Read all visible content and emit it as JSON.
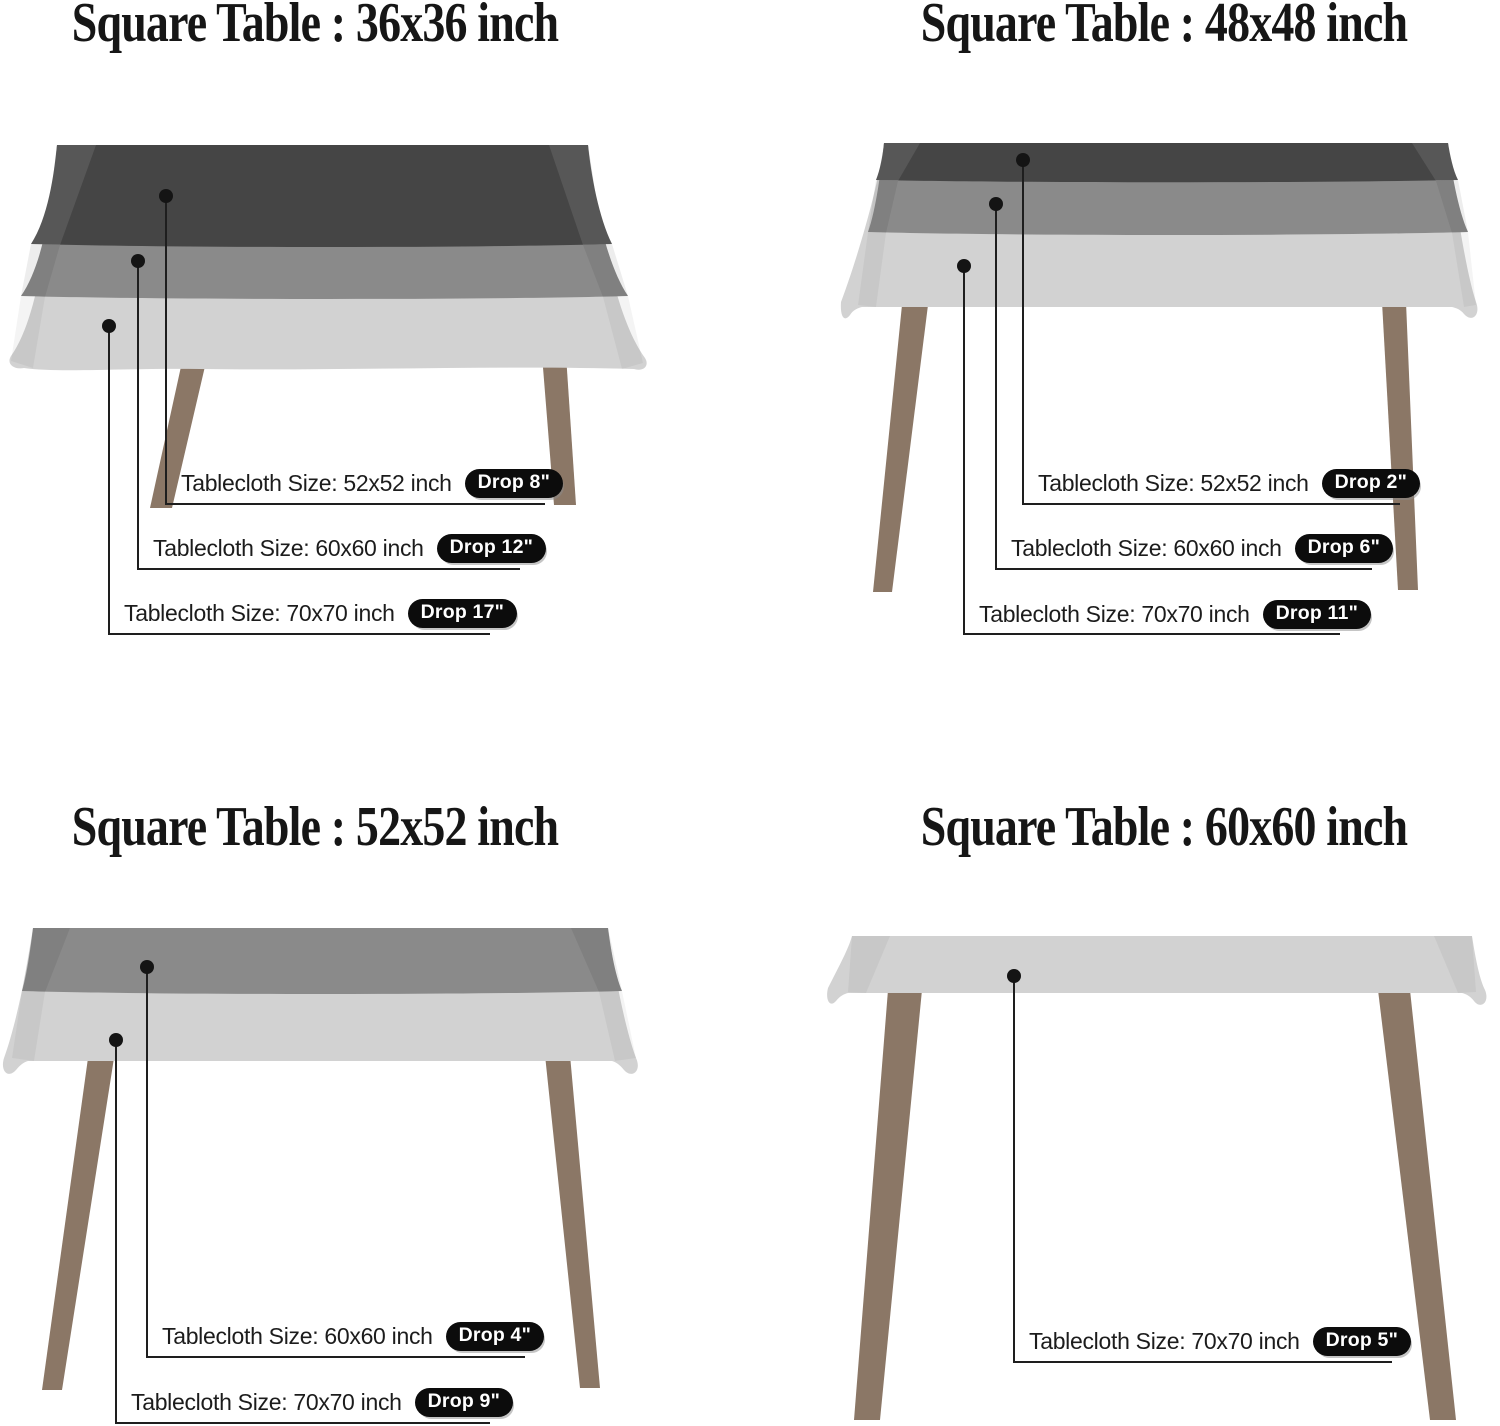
{
  "colors": {
    "cloth_dark": "#454545",
    "cloth_medium": "#8a8a8a",
    "cloth_light": "#d2d2d2",
    "leg": "#8b7766",
    "line": "#1e1e1e",
    "pill_bg": "#0c0c0c",
    "pill_text": "#ffffff"
  },
  "panels": [
    {
      "title": "Square Table : 36x36 inch",
      "callouts": [
        {
          "label": "Tablecloth Size: 52x52 inch",
          "drop": "Drop 8\""
        },
        {
          "label": "Tablecloth Size: 60x60 inch",
          "drop": "Drop 12\""
        },
        {
          "label": "Tablecloth Size: 70x70 inch",
          "drop": "Drop 17\""
        }
      ]
    },
    {
      "title": "Square Table : 48x48 inch",
      "callouts": [
        {
          "label": "Tablecloth Size: 52x52 inch",
          "drop": "Drop 2\""
        },
        {
          "label": "Tablecloth Size: 60x60 inch",
          "drop": "Drop 6\""
        },
        {
          "label": "Tablecloth Size: 70x70 inch",
          "drop": "Drop 11\""
        }
      ]
    },
    {
      "title": "Square Table : 52x52 inch",
      "callouts": [
        {
          "label": "Tablecloth Size: 60x60 inch",
          "drop": "Drop 4\""
        },
        {
          "label": "Tablecloth Size: 70x70 inch",
          "drop": "Drop 9\""
        }
      ]
    },
    {
      "title": "Square Table : 60x60 inch",
      "callouts": [
        {
          "label": "Tablecloth Size: 70x70 inch",
          "drop": "Drop 5\""
        }
      ]
    }
  ]
}
